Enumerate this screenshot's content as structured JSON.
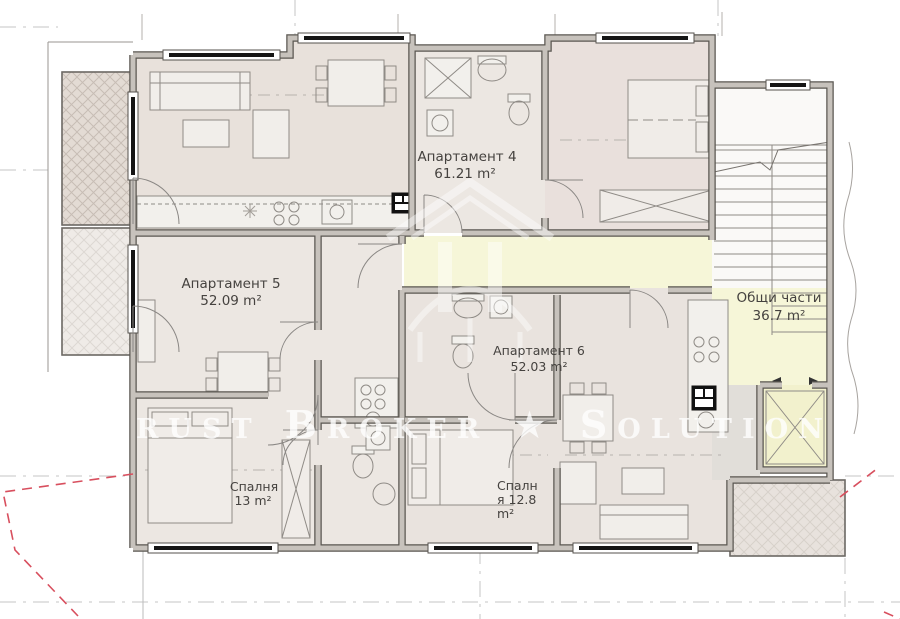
{
  "watermark_text": "Trust Broker ★ Solutions",
  "units": {
    "apartment4": {
      "name": "Апартамент 4",
      "area": "61.21 m²"
    },
    "apartment5": {
      "name": "Апартамент 5",
      "area": "52.09 m²"
    },
    "apartment6": {
      "name": "Апартамент 6",
      "area": "52.03 m²"
    },
    "common_areas": {
      "name": "Общи части",
      "area": "36.7 m²"
    },
    "bedroom_ap5": {
      "name": "Спалня",
      "area": "13 m²"
    },
    "bedroom_ap6": {
      "line1": "Спалн",
      "line2": "я  12.8",
      "line3": "m²"
    }
  },
  "colors": {
    "room_fill": "#ece7e2",
    "room_fill_warm": "#e8e0da",
    "corridor_fill": "#f6f6d8",
    "elevator_fill": "#f2f1cd",
    "wall_edge": "#5a5751",
    "wall_fill": "#c7c2bc",
    "window_bar": "#151515",
    "red_boundary": "#d84f5e",
    "site_grid": "#c6c6c6",
    "watermark": "#ffffff"
  }
}
